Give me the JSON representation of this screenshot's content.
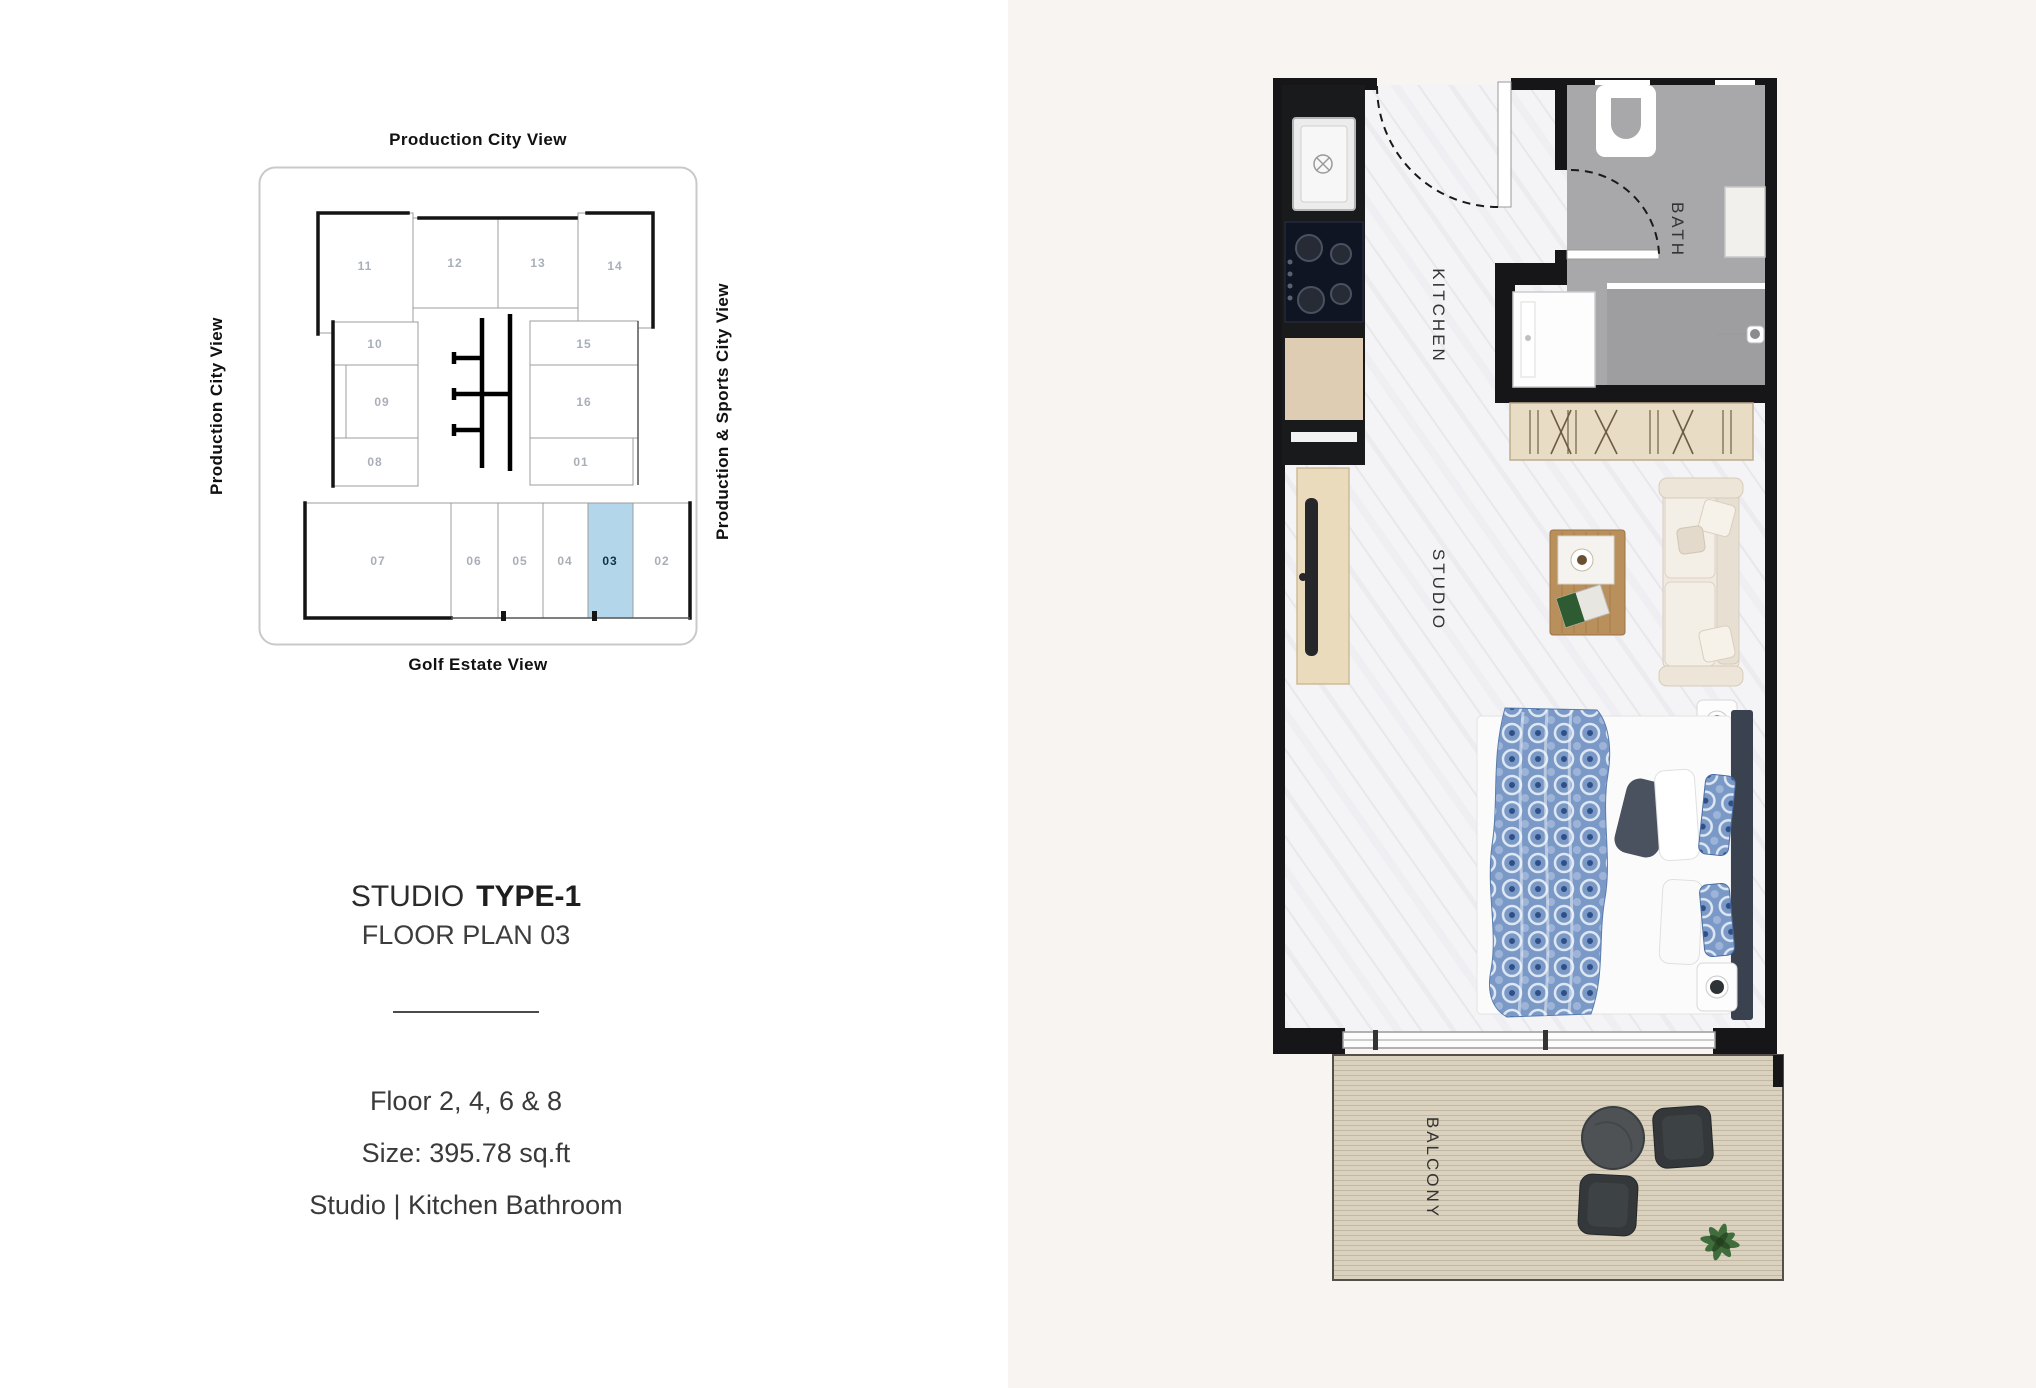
{
  "page": {
    "background_left": "#ffffff",
    "background_right": "#f8f4f1"
  },
  "key_plan": {
    "labels": {
      "top": "Production City View",
      "left": "Production City View",
      "right": "Production & Sports City View",
      "bottom": "Golf Estate View"
    },
    "highlighted_unit": "03",
    "highlight_color": "#b3d6eb",
    "units": [
      {
        "label": "11"
      },
      {
        "label": "12"
      },
      {
        "label": "13"
      },
      {
        "label": "14"
      },
      {
        "label": "10"
      },
      {
        "label": "09"
      },
      {
        "label": "08"
      },
      {
        "label": "15"
      },
      {
        "label": "16"
      },
      {
        "label": "01"
      },
      {
        "label": "07"
      },
      {
        "label": "06"
      },
      {
        "label": "05"
      },
      {
        "label": "04"
      },
      {
        "label": "03",
        "highlighted": true
      },
      {
        "label": "02"
      }
    ]
  },
  "details": {
    "title_regular": "STUDIO",
    "title_bold": "TYPE-1",
    "subtitle": "FLOOR PLAN 03",
    "floors": "Floor 2, 4, 6 & 8",
    "size": "Size: 395.78 sq.ft",
    "configuration": "Studio | Kitchen Bathroom"
  },
  "floor_plan": {
    "room_labels": {
      "kitchen": "KITCHEN",
      "bath": "BATH",
      "studio": "STUDIO",
      "balcony": "BALCONY"
    }
  },
  "colors": {
    "wall": "#161618",
    "bath_floor": "#a8a8ab",
    "balcony_deck": "#dad1be",
    "wardrobe": "#e9dcc4",
    "throw_blue": "#7b99c6",
    "sofa_cream": "#efe9df"
  }
}
